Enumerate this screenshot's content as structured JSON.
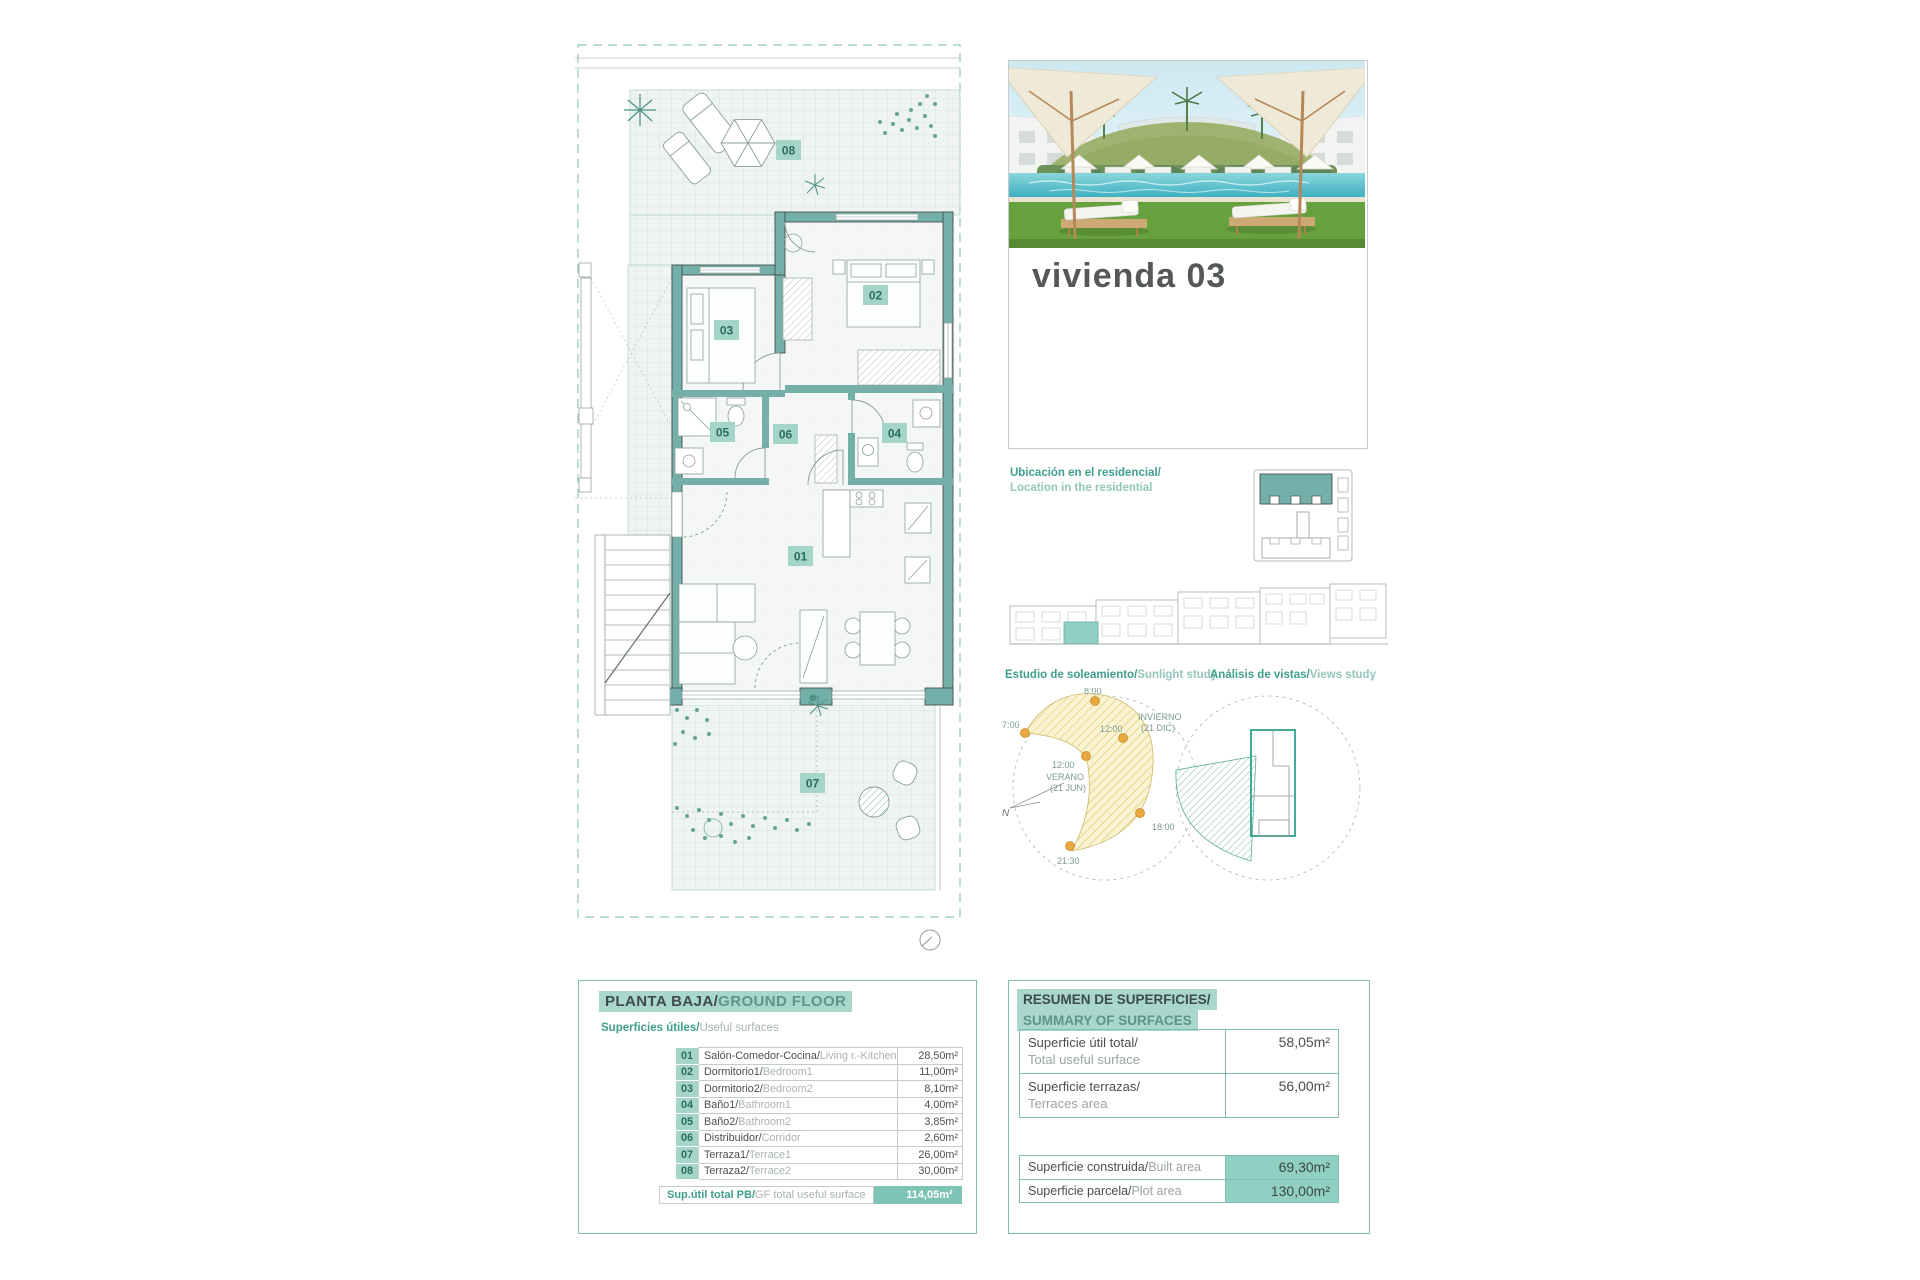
{
  "colors": {
    "accent_teal": "#74b0a9",
    "badge_bg": "#a5d4c8",
    "highlight_bg": "#a9d7cb",
    "sun_dot": "#e8a940",
    "yellow_band": "#faf3d2"
  },
  "photo_card": {
    "title": "vivienda 03"
  },
  "location_block": {
    "line_es": "Ubicación en el residencial/",
    "line_en": "Location in the residential"
  },
  "sun_study": {
    "title_es": "Estudio de soleamiento/",
    "title_en": "Sunlight study",
    "labels": {
      "t0800": "8:00",
      "t0700": "7:00",
      "t1200_winter": "12:00",
      "winter_line1": "INVIERNO",
      "winter_line2": "(21 DIC)",
      "t1200_summer": "12:00",
      "summer_line1": "VERANO",
      "summer_line2": "(21 JUN)",
      "t1800": "18:00",
      "t2130": "21:30",
      "north": "N"
    }
  },
  "views_study": {
    "title_es": "Análisis de vistas/",
    "title_en": "Views study"
  },
  "plan": {
    "badges": {
      "n01": "01",
      "n02": "02",
      "n03": "03",
      "n04": "04",
      "n05": "05",
      "n06": "06",
      "n07": "07",
      "n08": "08"
    }
  },
  "ground_floor_panel": {
    "title_es": "PLANTA BAJA/",
    "title_en": "GROUND FLOOR",
    "subtitle_es": "Superficies útiles/",
    "subtitle_en": "Useful surfaces",
    "rows": [
      {
        "num": "01",
        "name_es": "Salón-Comedor-Cocina/",
        "name_en": "Living r.-Kitchen",
        "value": "28,50m²"
      },
      {
        "num": "02",
        "name_es": "Dormitorio1/",
        "name_en": "Bedroom1",
        "value": "11,00m²"
      },
      {
        "num": "03",
        "name_es": "Dormitorio2/",
        "name_en": "Bedroom2",
        "value": "8,10m²"
      },
      {
        "num": "04",
        "name_es": "Baño1/",
        "name_en": "Bathroom1",
        "value": "4,00m²"
      },
      {
        "num": "05",
        "name_es": "Baño2/",
        "name_en": "Bathroom2",
        "value": "3,85m²"
      },
      {
        "num": "06",
        "name_es": "Distribuidor/",
        "name_en": "Corridor",
        "value": "2,60m²"
      },
      {
        "num": "07",
        "name_es": "Terraza1/",
        "name_en": "Terrace1",
        "value": "26,00m²"
      },
      {
        "num": "08",
        "name_es": "Terraza2/",
        "name_en": "Terrace2",
        "value": "30,00m²"
      }
    ],
    "total": {
      "label_es": "Sup.útil total PB/",
      "label_en": "GF total useful surface",
      "value": "114,05m²"
    }
  },
  "summary_panel": {
    "title_es": "RESUMEN DE SUPERFICIES/",
    "title_en": "SUMMARY OF SURFACES",
    "useful": {
      "label_es": "Superficie útil total/",
      "label_en": "Total useful surface",
      "value": "58,05m²"
    },
    "terraces": {
      "label_es": "Superficie terrazas/",
      "label_en": "Terraces area",
      "value": "56,00m²"
    },
    "built": {
      "label_es": "Superficie construida/",
      "label_en": "Built area",
      "value": "69,30m²"
    },
    "plot": {
      "label_es": "Superficie parcela/",
      "label_en": "Plot area",
      "value": "130,00m²"
    }
  }
}
